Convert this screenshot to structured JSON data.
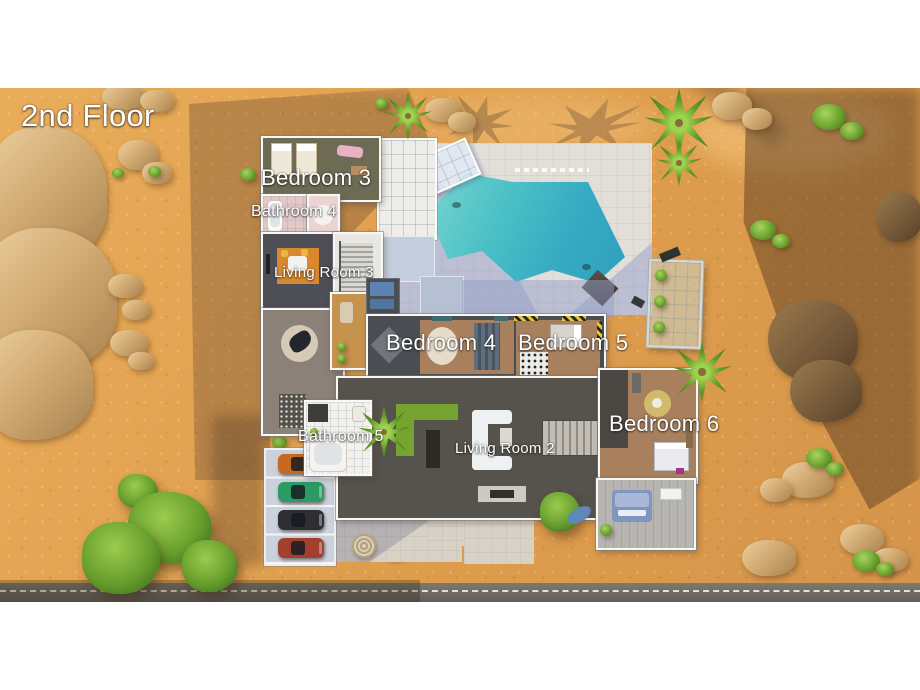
{
  "scene": {
    "labels": {
      "floor": "2nd Floor",
      "bedroom3": "Bedroom 3",
      "bathroom4": "Bathroom 4",
      "living_room3": "Living Room 3",
      "bedroom4": "Bedroom 4",
      "bedroom5": "Bedroom 5",
      "bedroom6": "Bedroom 6",
      "bathroom5": "Bathroom 5",
      "living_room2": "Living Room 2"
    }
  },
  "cars": [
    {
      "color": "#c56a20"
    },
    {
      "color": "#2b9a63"
    },
    {
      "color": "#2f2f33"
    },
    {
      "color": "#a33f2f"
    }
  ],
  "colors": {
    "sand": "#e2a251",
    "sand_shadow": "#a3773f",
    "pool_water": "#3db4c6",
    "patio": "#e2dfd9",
    "road": "#6b675f",
    "label_text": "#ffffff"
  }
}
